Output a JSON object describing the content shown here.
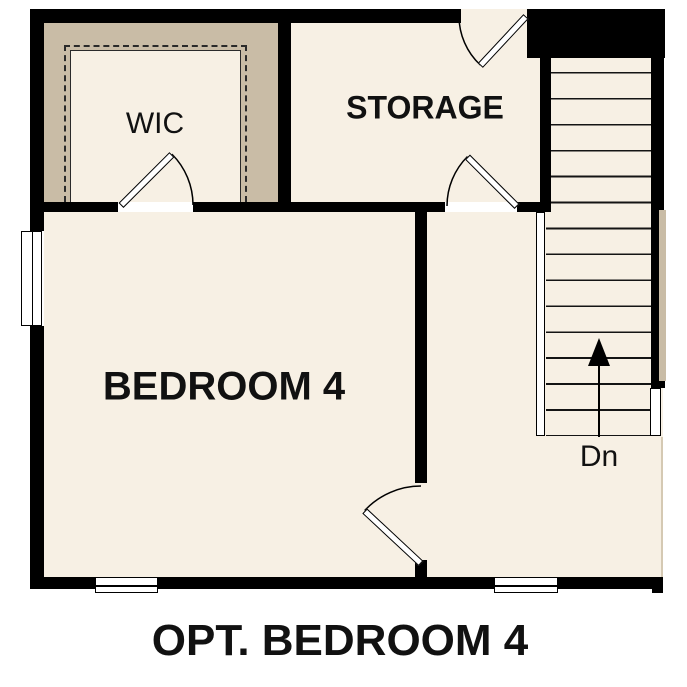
{
  "plan": {
    "caption": "OPT. BEDROOM 4",
    "rooms": {
      "wic": {
        "label": "WIC"
      },
      "storage": {
        "label": "STORAGE"
      },
      "bedroom": {
        "label": "BEDROOM 4"
      },
      "stairs": {
        "direction_label": "Dn"
      }
    },
    "colors": {
      "wall": "#000000",
      "floor": "#f7f0e4",
      "optional_area_tan": "#c9bca6",
      "text": "#111111",
      "background": "#ffffff"
    }
  }
}
